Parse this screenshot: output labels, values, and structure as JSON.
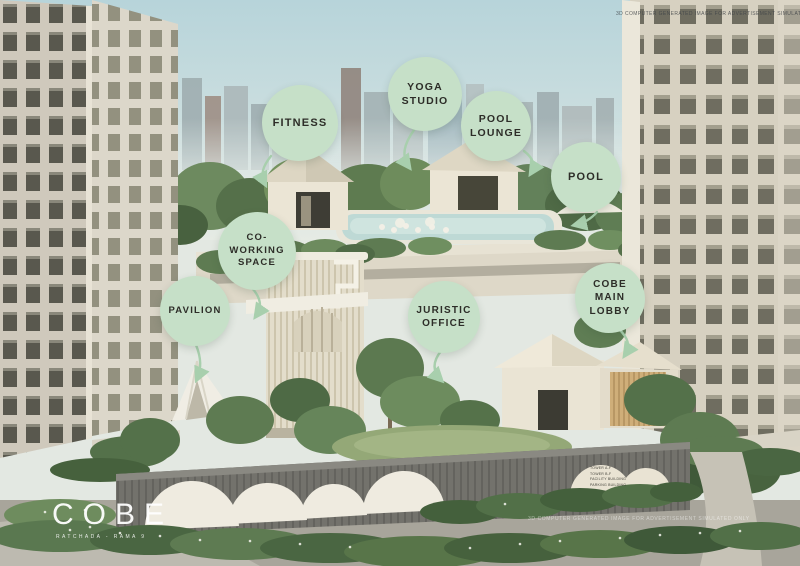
{
  "brand": {
    "logo": "COBE",
    "tagline": "RATCHADA - RAMA 9"
  },
  "watermarks": {
    "top_right": "3D COMPUTER GENERATED IMAGE FOR ADVERTISEMENT SIMULATED ONLY",
    "bottom_right": "3D COMPUTER GENERATED IMAGE FOR ADVERTISEMENT SIMULATED ONLY"
  },
  "callouts": [
    {
      "id": "fitness",
      "lines": [
        "FITNESS"
      ]
    },
    {
      "id": "yoga-studio",
      "lines": [
        "YOGA",
        "STUDIO"
      ]
    },
    {
      "id": "pool-lounge",
      "lines": [
        "POOL",
        "LOUNGE"
      ]
    },
    {
      "id": "pool",
      "lines": [
        "POOL"
      ]
    },
    {
      "id": "co-working-space",
      "lines": [
        "CO-",
        "WORKING",
        "SPACE"
      ]
    },
    {
      "id": "pavilion",
      "lines": [
        "PAVILION"
      ]
    },
    {
      "id": "juristic-office",
      "lines": [
        "JURISTIC",
        "OFFICE"
      ]
    },
    {
      "id": "cobe-main-lobby",
      "lines": [
        "COBE",
        "MAIN",
        "LOBBY"
      ]
    }
  ],
  "directory_sign": {
    "lines": [
      "TOWER A-F",
      "TOWER B-F",
      "FACILITY BUILDING",
      "PARKING BUILDING"
    ]
  },
  "colors": {
    "bubble": "#c6e0c8",
    "bubble_text": "#2d2d28",
    "arrow": "#a8cfad",
    "logo_text": "#ffffff"
  }
}
